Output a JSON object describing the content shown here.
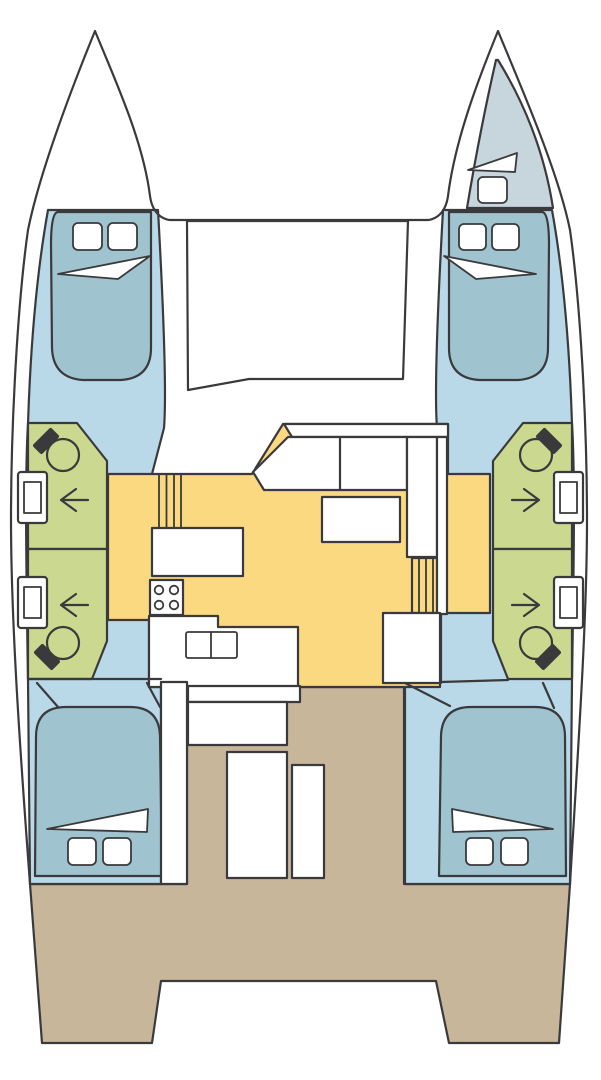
{
  "title": "Catamaran yacht deck plan (bow up)",
  "colors": {
    "outline": "#3a3a3c",
    "hull_white": "#ffffff",
    "cabin_floor": "#b9d9e9",
    "bed": "#9fc3cf",
    "forepeak": "#c6d6dc",
    "bathroom": "#cbd890",
    "salon": "#fbd981",
    "deck": "#c8b69b"
  },
  "plan": {
    "type": "diagram",
    "vessel": "sailing catamaran floor plan",
    "orientation": "bow-up",
    "hulls": 2,
    "rooms": {
      "forward_double_cabins": 2,
      "aft_double_cabins": 2,
      "forepeak_berths": 1,
      "bathrooms": 4,
      "shower_arrows": 4,
      "toilets": 4,
      "washbasins": 4,
      "salon": {
        "galley_burners": 4,
        "sink_basins": 2,
        "dinette_tables": 1,
        "sofa_seats": 2,
        "stairways": 2
      },
      "cockpit": {
        "benches": 2,
        "tables": 1
      },
      "foredeck_lockers": 1
    },
    "pillows_total": 9
  }
}
